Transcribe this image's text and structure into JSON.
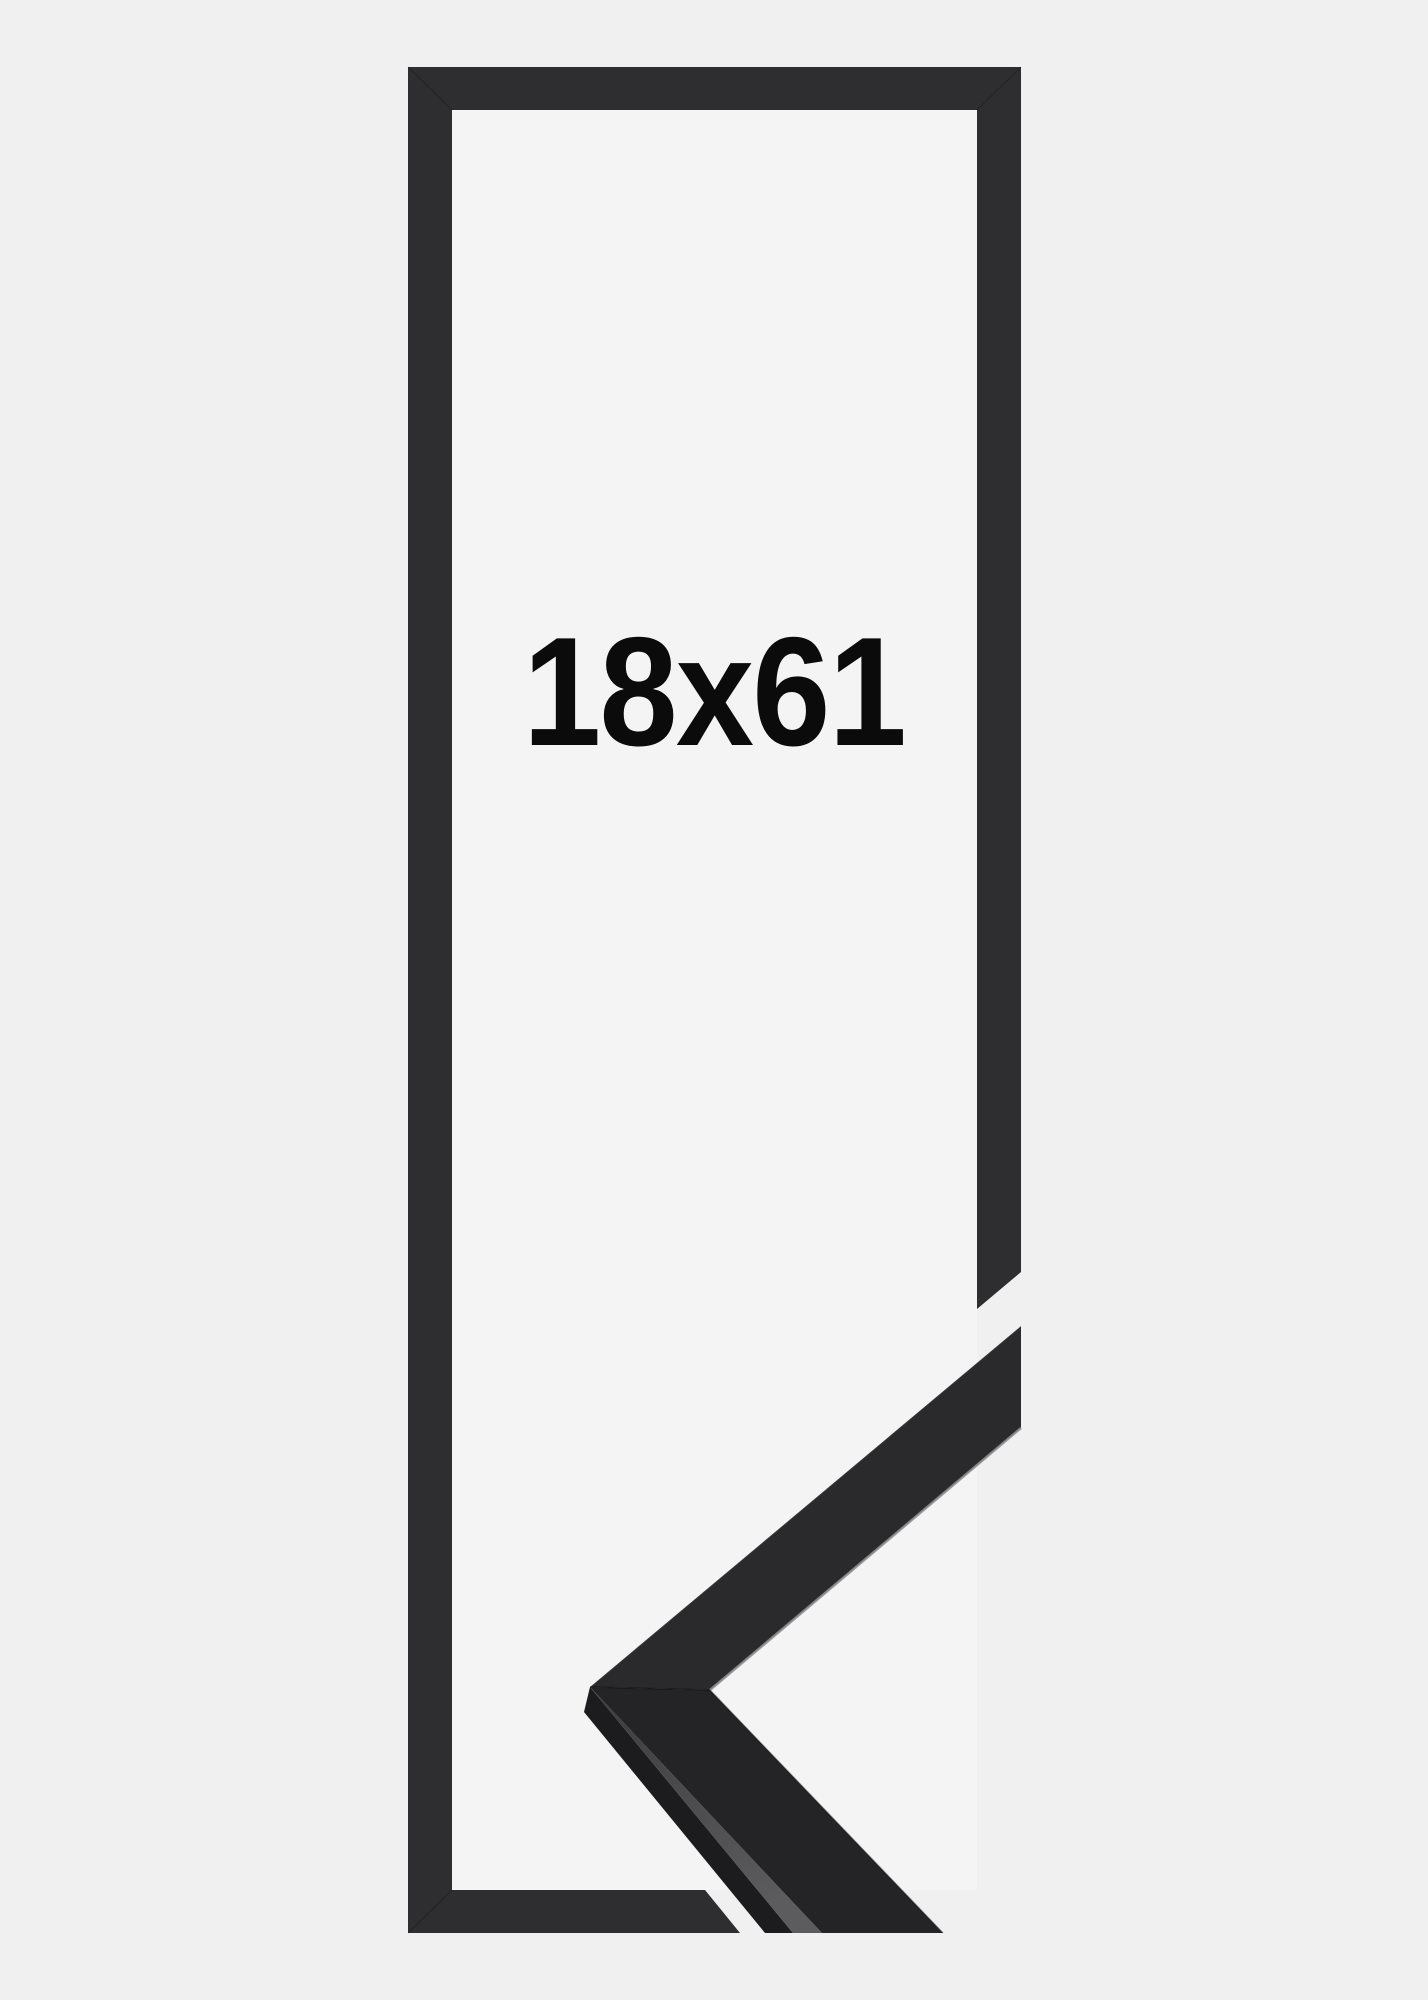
{
  "image": {
    "size_label": "18x61",
    "colors": {
      "background": "#f0f0f1",
      "frame_opening": "#f4f4f5",
      "frame_outline": "#2e2e30",
      "label_text": "#0b0b0b",
      "sample_upper_face": "#2a2a2c",
      "sample_front_face": "#242426",
      "sample_edge_lip": "#1c1c1e",
      "sample_top_stripe_dark": "#3a3a3c",
      "sample_top_stripe_light": "#5c5c5e",
      "sample_arris_highlight": "#8e8e90"
    }
  }
}
